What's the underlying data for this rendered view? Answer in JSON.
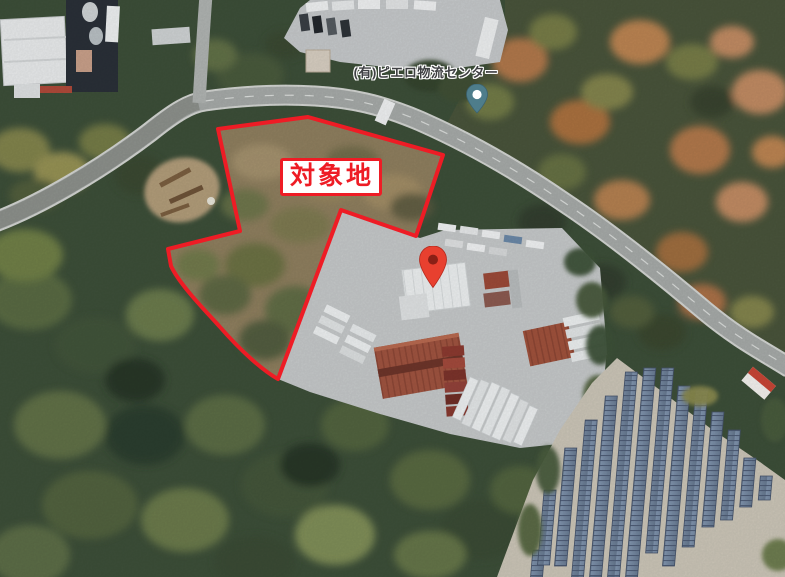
{
  "annotation": {
    "target_area_label": "対象地",
    "outline_color": "#ee1c25",
    "label_background": "#ffffff",
    "label_text_color": "#ee1c25"
  },
  "places": {
    "logistics_center": {
      "name": "(有)ピエロ物流センター",
      "pin_icon": "teal-place-pin-icon",
      "pin_color": "#4e7d8b"
    }
  },
  "marker": {
    "icon": "red-map-pin-icon",
    "color": "#e8402f",
    "inner_dot_color": "#8a2016"
  },
  "terrain_colors": {
    "forest_dark": "#3d4f39",
    "forest_olive": "#6d7a48",
    "autumn_orange": "#bd7d4e",
    "scrub_tan": "#8f7f5f",
    "road_gray": "#a7aba9",
    "yard_concrete": "#c6c9ca",
    "solar_panel_blue": "#74889f",
    "rust_roof": "#a05440"
  }
}
